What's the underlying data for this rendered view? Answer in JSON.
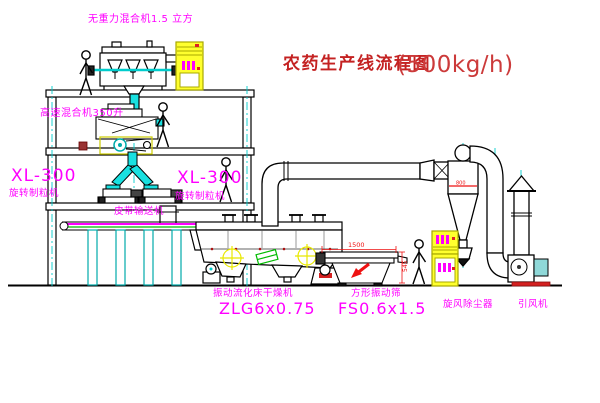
{
  "title": {
    "text": "农药生产线流程图",
    "capacity": "(500kg/h)"
  },
  "equipment_labels": {
    "gravity_free_mixer": "无重力混合机1.5 立方",
    "high_speed_mixer": "高速混合机350升",
    "granulator_left_model": "XL-300",
    "granulator_left_name": "旋转制粒机",
    "granulator_right_model": "XL-300",
    "granulator_right_name": "旋转制粒机",
    "belt_conveyor": "皮带输送机",
    "fluid_bed_dryer_name": "振动流化床干燥机",
    "fluid_bed_dryer_model": "ZLG6x0.75",
    "square_sieve_name": "方形振动筛",
    "square_sieve_model": "FS0.6x1.5",
    "cyclone_dust_collector": "旋风除尘器",
    "induced_draft_fan": "引风机"
  },
  "dimension_annotations": {
    "sieve_length": "1500",
    "sieve_height": "545",
    "cyclone_diameter": "800"
  },
  "colors": {
    "label_magenta": "#ff00ff",
    "title_red": "#c42222",
    "capacity_red": "#cc3a3a",
    "dimension_red": "#ee1111",
    "centerline_cyan": "#00cccc",
    "duct_cyan": "#19e0e0",
    "cabinet_yellow": "#ffff2e",
    "crosshair_yellow": "#e8e800",
    "detail_green": "#00bb00"
  }
}
